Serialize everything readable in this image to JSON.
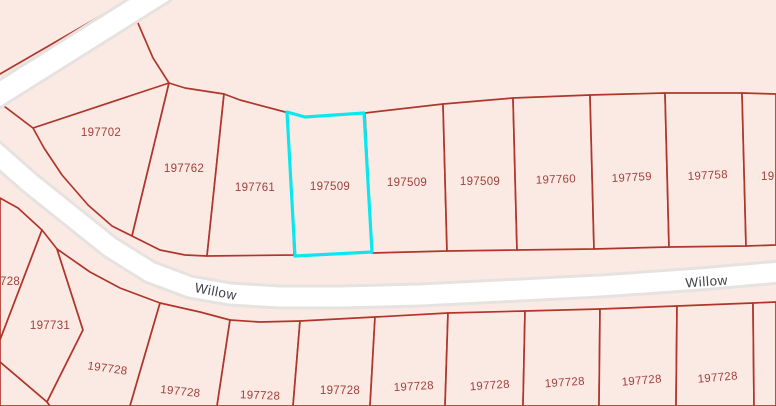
{
  "map": {
    "kind": "cadastral-parcel-map",
    "street": {
      "name": "Willow",
      "left_label": "Willow",
      "right_label": "Willow"
    },
    "parcels": {
      "highlighted": "197509",
      "top_row": [
        "197702",
        "197762",
        "197761",
        "197509",
        "197509",
        "197509",
        "197760",
        "197759",
        "197758",
        "19"
      ],
      "left_column": [
        "728",
        "197731"
      ],
      "bottom_row": [
        "197728",
        "197728",
        "197728",
        "197728",
        "197728",
        "197728",
        "197728",
        "197728",
        "197728"
      ]
    },
    "colors": {
      "background": "#fbeae4",
      "parcel_line": "#b0362c",
      "parcel_label": "#a23f3c",
      "highlight": "#0be7ef",
      "road_fill": "#ffffff",
      "road_casing": "#e6e2df",
      "street_label": "#3f4247"
    }
  }
}
